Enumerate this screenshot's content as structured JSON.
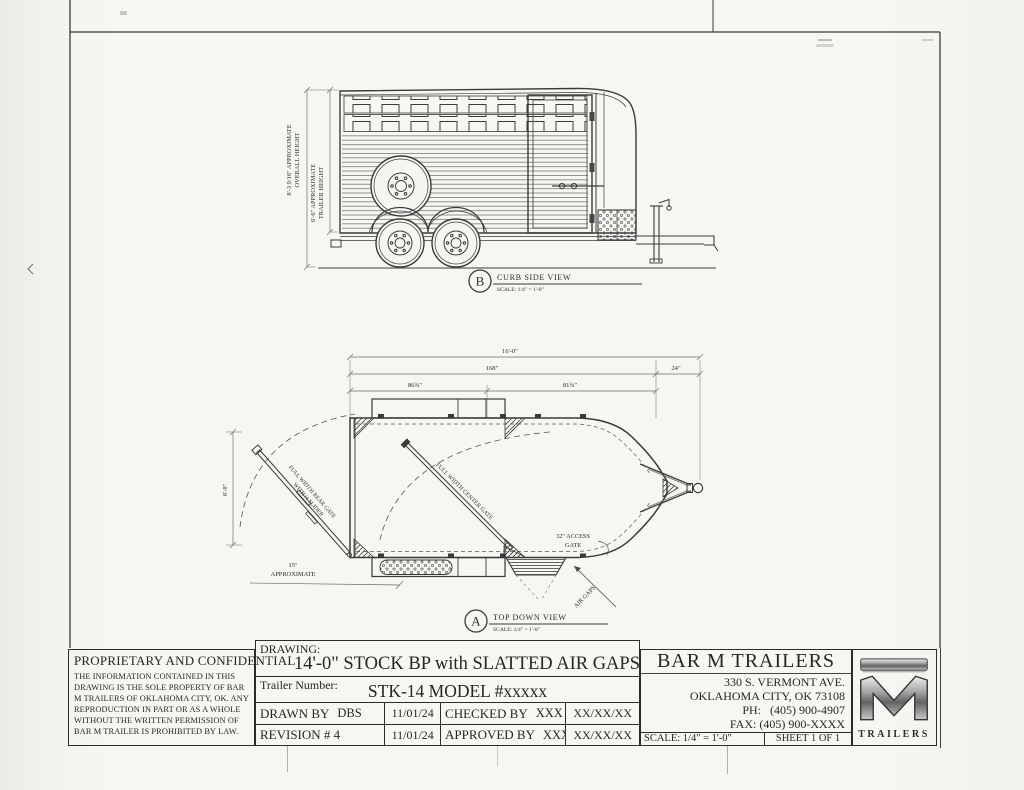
{
  "colors": {
    "paper": "#f6f5f1",
    "ink": "#2e2e2e",
    "ink_light": "#666666"
  },
  "side_view": {
    "marker_letter": "B",
    "title": "CURB SIDE VIEW",
    "scale": "SCALE: 1/4\" = 1'-0\"",
    "overall_height_line1": "8'-3 9/16\" APPROXIMATE",
    "overall_height_line2": "OVERALL HEIGHT",
    "trailer_height_line1": "6'-6\" APPROXIMATE",
    "trailer_height_line2": "TRAILER HEIGHT"
  },
  "top_view": {
    "marker_letter": "A",
    "title": "TOP DOWN VIEW",
    "scale": "SCALE: 1/4\" = 1'-0\"",
    "dim_overall_length": "16'-0\"",
    "dim_box_length": "168\"",
    "dim_tongue_length": "24\"",
    "dim_rear_section": "86¾\"",
    "dim_front_section": "81¾\"",
    "dim_width": "6'-8\"",
    "dim_rear_approx_value": "15\"",
    "dim_rear_approx_word": "APPROXIMATE",
    "rear_gate_line1": "FULL WIDTH REAR GATE",
    "rear_gate_line2": "WITH ½ SLIDER",
    "center_gate_label": "FULL WIDTH CENTER GATE",
    "access_gate_line1": "32\" ACCESS",
    "access_gate_line2": "GATE",
    "air_gaps_label": "AIR GAPS"
  },
  "title_block": {
    "proprietary_heading": "PROPRIETARY AND CONFIDENTIAL",
    "proprietary_body": "THE INFORMATION CONTAINED IN THIS DRAWING IS THE SOLE PROPERTY OF BAR M TRAILERS OF OKLAHOMA CITY, OK. ANY REPRODUCTION IN PART OR AS A WHOLE WITHOUT THE WRITTEN PERMISSION OF BAR M TRAILER IS PROHIBITED BY LAW.",
    "drawing_label": "DRAWING:",
    "drawing_title": "14'-0\" STOCK BP with SLATTED AIR GAPS",
    "trailer_number_label": "Trailer Number:",
    "trailer_number": "STK-14 MODEL #xxxxx",
    "drawn_by_label": "DRAWN BY",
    "drawn_by": "DBS",
    "drawn_date": "11/01/24",
    "checked_by_label": "CHECKED BY",
    "checked_by": "XXX",
    "checked_date": "XX/XX/XX",
    "revision": "REVISION # 4",
    "revision_date": "11/01/24",
    "approved_by_label": "APPROVED BY",
    "approved_by": "XXX",
    "approved_date": "XX/XX/XX",
    "company_name": "BAR M TRAILERS",
    "address_line1": "330 S. VERMONT AVE.",
    "address_line2": "OKLAHOMA CITY, OK 73108",
    "phone_label": "PH:",
    "phone": "(405) 900-4907",
    "fax_label": "FAX:",
    "fax": "(405) 900-XXXX",
    "scale": "SCALE: 1/4\" = 1'-0\"",
    "sheet": "SHEET 1 OF 1",
    "logo_text": "TRAILERS"
  }
}
